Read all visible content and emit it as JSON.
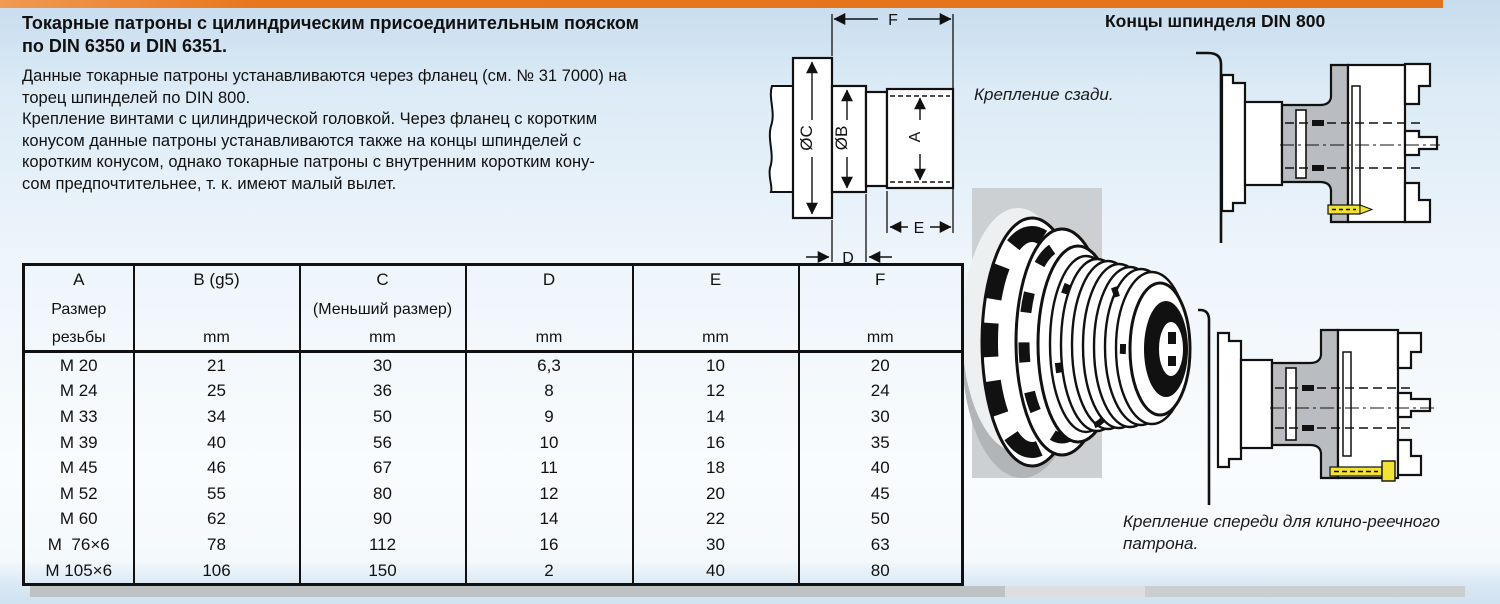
{
  "intro": {
    "title_lines": [
      "Токарные патроны с цилиндрическим присоединительным пояском",
      "по DIN 6350 и DIN 6351."
    ],
    "body_lines": [
      "Данные токарные патроны устанавливаются через фланец (см. № 31 7000) на",
      "торец шпинделей по DIN 800.",
      "Крепление винтами с цилиндрической головкой. Через фланец с коротким",
      "конусом данные патроны устанавливаются также на концы шпинделей с",
      "коротким конусом, однако токарные патроны с внутренним коротким кону-",
      "сом предпочтительнее, т. к. имеют малый вылет."
    ]
  },
  "diagram": {
    "labels": {
      "f": "F",
      "oc": "ØC",
      "ob": "ØB",
      "a": "A",
      "e": "E",
      "d": "D"
    }
  },
  "right_panel": {
    "title": "Концы шпинделя DIN 800",
    "caption_back": "Крепление сзади.",
    "caption_front_lines": [
      "Крепление спереди для клино-реечного",
      "патрона."
    ]
  },
  "table": {
    "columns": [
      {
        "l1": "A",
        "l2": "Размер",
        "l3": "резьбы",
        "unit": ""
      },
      {
        "l1": "B (g5)",
        "l2": "",
        "l3": "",
        "unit": "mm"
      },
      {
        "l1": "C",
        "l2": "(Меньший размер)",
        "l3": "",
        "unit": "mm"
      },
      {
        "l1": "D",
        "l2": "",
        "l3": "",
        "unit": "mm"
      },
      {
        "l1": "E",
        "l2": "",
        "l3": "",
        "unit": "mm"
      },
      {
        "l1": "F",
        "l2": "",
        "l3": "",
        "unit": "mm"
      }
    ],
    "rows": [
      {
        "a": "M 20",
        "b": "21",
        "c": "30",
        "d": "6,3",
        "e": "10",
        "f": "20"
      },
      {
        "a": "M 24",
        "b": "25",
        "c": "36",
        "d": "8",
        "e": "12",
        "f": "24"
      },
      {
        "a": "M 33",
        "b": "34",
        "c": "50",
        "d": "9",
        "e": "14",
        "f": "30"
      },
      {
        "a": "M 39",
        "b": "40",
        "c": "56",
        "d": "10",
        "e": "16",
        "f": "35"
      },
      {
        "a": "M 45",
        "b": "46",
        "c": "67",
        "d": "11",
        "e": "18",
        "f": "40"
      },
      {
        "a": "M 52",
        "b": "55",
        "c": "80",
        "d": "12",
        "e": "20",
        "f": "45"
      },
      {
        "a": "M 60",
        "b": "62",
        "c": "90",
        "d": "14",
        "e": "22",
        "f": "50"
      },
      {
        "a": "M  76×6",
        "b": "78",
        "c": "112",
        "d": "16",
        "e": "30",
        "f": "63"
      },
      {
        "a": "M 105×6",
        "b": "106",
        "c": "150",
        "d": "2",
        "e": "40",
        "f": "80"
      }
    ]
  }
}
